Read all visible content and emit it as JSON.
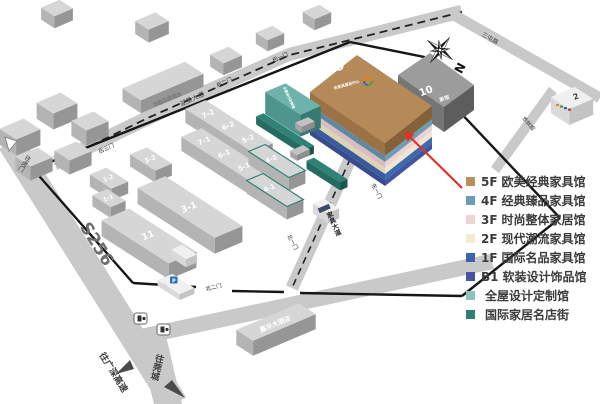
{
  "legend": {
    "items": [
      {
        "floor": "5F",
        "name": "欧美经典家具馆",
        "color": "#b8905a"
      },
      {
        "floor": "4F",
        "name": "经典臻品家具馆",
        "color": "#6d9cb4"
      },
      {
        "floor": "3F",
        "name": "时尚整体家居馆",
        "color": "#eed3d7"
      },
      {
        "floor": "2F",
        "name": "现代潮流家具馆",
        "color": "#f2ecd2"
      },
      {
        "floor": "1F",
        "name": "国际名品家具馆",
        "color": "#3c63ab"
      },
      {
        "floor": "B1",
        "name": "软装设计饰品馆",
        "color": "#45569f"
      },
      {
        "floor": "",
        "name": "全屋设计定制馆",
        "color": "#8fc2bc"
      },
      {
        "floor": "",
        "name": "国际家居名店街",
        "color": "#2c8074"
      }
    ]
  },
  "map": {
    "compass_label": "N",
    "halls": {
      "h72": "7-2",
      "h62": "6-2",
      "h52": "5-2",
      "h71": "7-1",
      "h61": "6-1",
      "h51": "5-1",
      "h42": "4-2",
      "h41": "4-1",
      "h32": "3-2",
      "h31": "3-1",
      "h12": "1-2",
      "h11": "1-1",
      "h11b": "11",
      "h9": "9",
      "h9sub": "名家具展览中心",
      "h10": "10",
      "h10sub": "新馆",
      "h8": "8",
      "h8sub": "全屋设计定制馆",
      "h2": "2"
    },
    "gates": {
      "g1": "后一门",
      "g2": "后二门",
      "g3": "后三门",
      "e1": "东一门",
      "n1": "北一门",
      "n2": "北二门"
    },
    "roads": {
      "top": "湖景大道",
      "topright": "三屯路",
      "right": "体育路",
      "east": "家具大道",
      "provincial": "S256"
    },
    "directions": {
      "humen": "往虎门",
      "expressway": "往广深高速",
      "guancheng": "往莞城"
    },
    "landmarks": {
      "hotel_north": "华庭花园酒店",
      "hotel_south": "嘉华大酒店",
      "parking": "P"
    },
    "colors": {
      "arrow": "#e03126",
      "border": "#161616",
      "road": "#c9c9c9"
    }
  }
}
